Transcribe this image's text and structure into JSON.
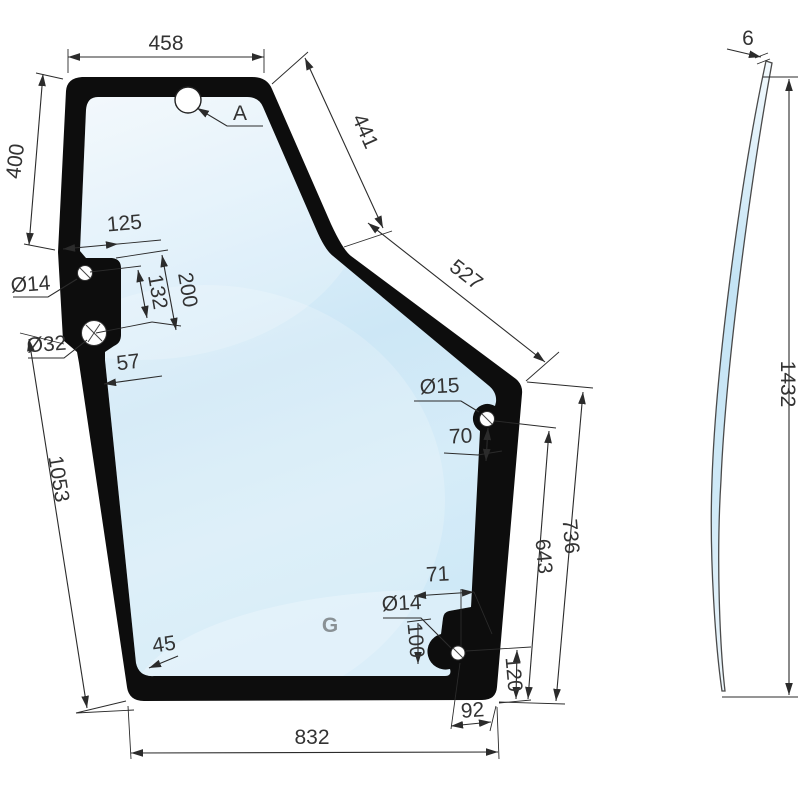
{
  "drawing": {
    "watermark": "G",
    "detail_label": "A",
    "front": {
      "top_width": "458",
      "upper_left_height": "400",
      "upper_right_edge1": "441",
      "upper_right_edge2": "527",
      "tab_offset": "125",
      "tab_hole_spacing": "132",
      "tab_span": "200",
      "tab_hole_small": "Ø14",
      "tab_hole_large": "Ø32",
      "band_width": "57",
      "lower_left_edge": "1053",
      "right_hole": "Ø15",
      "right_hole_offset": "70",
      "right_inner_height": "643",
      "right_outer_height": "736",
      "bottom_hole_offset_x": "71",
      "bottom_hole": "Ø14",
      "bottom_hole_offset_y": "100",
      "corner_radius": "45",
      "bottom_right_height": "120",
      "bottom_right_width": "92",
      "bottom_width": "832"
    },
    "side": {
      "thickness": "6",
      "height": "1432"
    },
    "colors": {
      "frame": "#0d0d0d",
      "glass_light": "#eff7fc",
      "glass_mid": "#cfe8f6",
      "dim_line": "#2b2b2b",
      "background": "#ffffff"
    }
  }
}
